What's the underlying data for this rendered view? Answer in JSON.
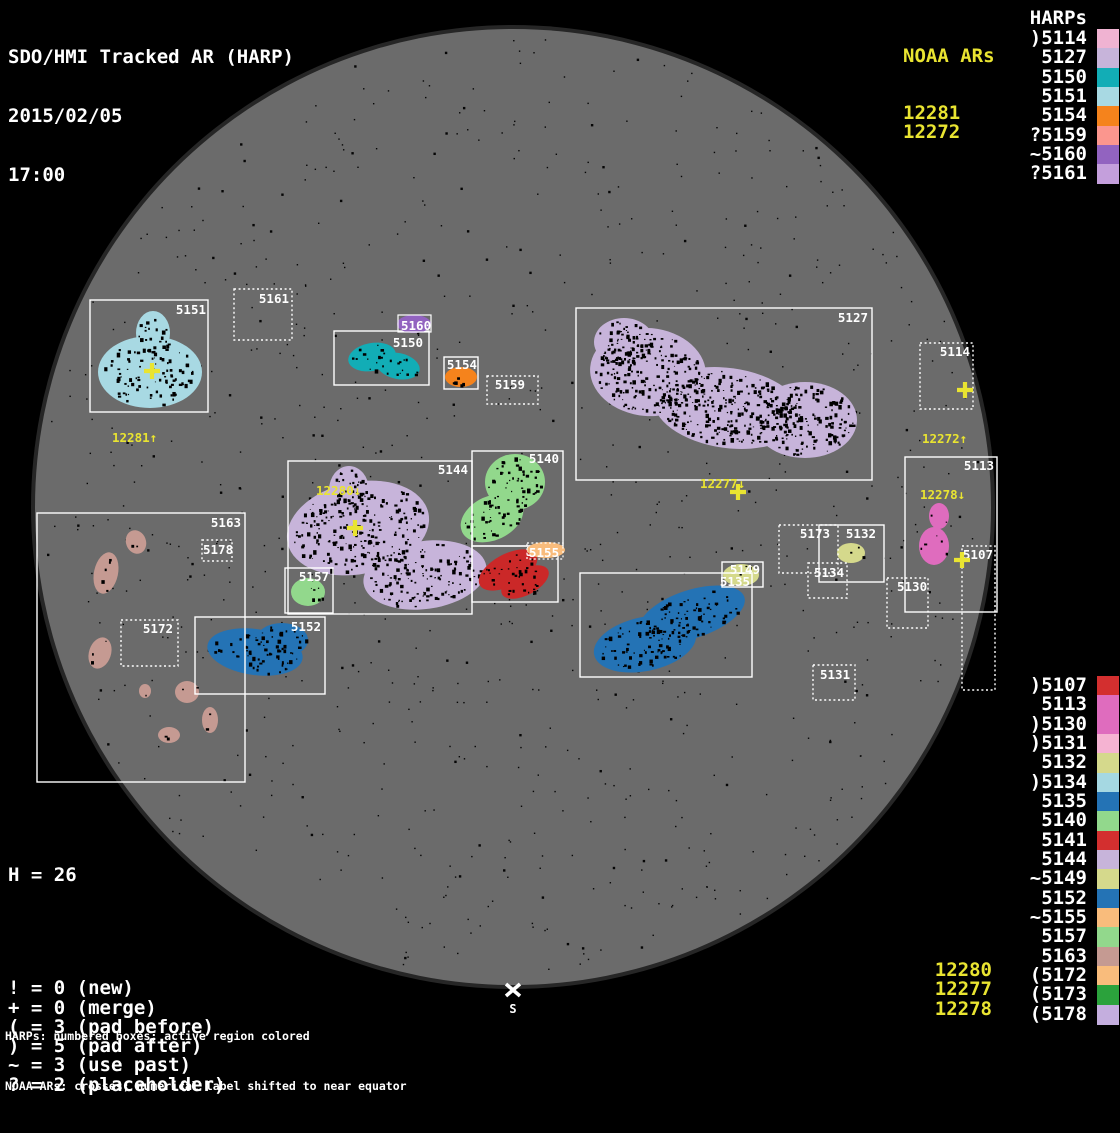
{
  "title": {
    "line1": "SDO/HMI Tracked AR (HARP)",
    "line2": "2015/02/05",
    "line3": "17:00"
  },
  "palette": {
    "yellow": "#e9e431",
    "white": "#ffffff",
    "disk_gray": "#6b6b6b",
    "disk_rim": "#262626",
    "background": "#000000",
    "speckle": "#050505"
  },
  "noaa_top": {
    "header": "NOAA ARs",
    "items": [
      "12281",
      "12272"
    ]
  },
  "harps_top": {
    "header": "HARPs",
    "items": [
      {
        "label": ")5114",
        "color": "#f0b3d2"
      },
      {
        "label": "5127",
        "color": "#c7b4da"
      },
      {
        "label": "5150",
        "color": "#12adb6"
      },
      {
        "label": "5151",
        "color": "#a8d9e3"
      },
      {
        "label": "5154",
        "color": "#f5831c"
      },
      {
        "label": "?5159",
        "color": "#fb968e"
      },
      {
        "label": "~5160",
        "color": "#9263c0"
      },
      {
        "label": "?5161",
        "color": "#c49fdc"
      }
    ]
  },
  "harps_bottom": {
    "items": [
      {
        "label": ")5107",
        "color": "#d32f2f"
      },
      {
        "label": "5113",
        "color": "#df6cbe"
      },
      {
        "label": ")5130",
        "color": "#df6cbe"
      },
      {
        "label": ")5131",
        "color": "#f5b3d2"
      },
      {
        "label": "5132",
        "color": "#d5d98c"
      },
      {
        "label": ")5134",
        "color": "#a5d8e2"
      },
      {
        "label": "5135",
        "color": "#2473b5"
      },
      {
        "label": "5140",
        "color": "#92d88c"
      },
      {
        "label": "5141",
        "color": "#d32f2f"
      },
      {
        "label": "5144",
        "color": "#c7b4da"
      },
      {
        "label": "~5149",
        "color": "#d5d98c"
      },
      {
        "label": "5152",
        "color": "#2473b5"
      },
      {
        "label": "~5155",
        "color": "#f9bc7c"
      },
      {
        "label": "5157",
        "color": "#92d88c"
      },
      {
        "label": "5163",
        "color": "#c59a92"
      },
      {
        "label": "(5172",
        "color": "#f9bc7c"
      },
      {
        "label": "(5173",
        "color": "#2ba23c"
      },
      {
        "label": "(5178",
        "color": "#c4aede"
      }
    ]
  },
  "noaa_bottom": [
    "12280",
    "12277",
    "12278"
  ],
  "stats": {
    "h": "H = 26",
    "legend": [
      "! = 0 (new)",
      "+ = 0 (merge)",
      "( = 3 (pad before)",
      ") = 5 (pad after)",
      "~ = 3 (use past)",
      "? = 2 (placeholder)"
    ]
  },
  "footer": [
    "HARPs: numbered boxes; active region colored",
    "NOAA ARs: crosses; numerical label shifted to near equator"
  ],
  "south_marker": {
    "text": "S",
    "x": 513,
    "y": 1013,
    "cross_x": 513,
    "cross_y": 990
  },
  "disk": {
    "cx": 513,
    "cy": 507,
    "r": 478
  },
  "regions": [
    {
      "harp": "5151",
      "box": [
        90,
        300,
        118,
        112
      ],
      "border": "solid",
      "label": {
        "text": "5151",
        "x": 206,
        "y": 314,
        "anchor": "end"
      },
      "color": "#a8d9e3",
      "blobs": [
        [
          150,
          372,
          52,
          36,
          0
        ],
        [
          153,
          333,
          17,
          22,
          0
        ]
      ],
      "speckle": 1.4
    },
    {
      "harp": "5161",
      "box": [
        234,
        289,
        58,
        51
      ],
      "border": "dashed",
      "label": {
        "text": "5161",
        "x": 289,
        "y": 303,
        "anchor": "end"
      }
    },
    {
      "harp": "5150",
      "box": [
        334,
        331,
        95,
        54
      ],
      "border": "solid",
      "label": {
        "text": "5150",
        "x": 423,
        "y": 347,
        "anchor": "end"
      },
      "color": "#12adb6",
      "blobs": [
        [
          372,
          357,
          24,
          14,
          -10
        ],
        [
          398,
          366,
          22,
          13,
          12
        ]
      ],
      "speckle": 1.2
    },
    {
      "harp": "5154",
      "box": [
        444,
        357,
        34,
        32
      ],
      "border": "solid",
      "label": {
        "text": "5154",
        "x": 477,
        "y": 369,
        "anchor": "end"
      },
      "color": "#f5831c",
      "blobs": [
        [
          461,
          377,
          16,
          10,
          0
        ]
      ],
      "speckle": 1.0
    },
    {
      "harp": "5159",
      "box": [
        487,
        376,
        51,
        28
      ],
      "border": "dashed",
      "label": {
        "text": "5159",
        "x": 525,
        "y": 389,
        "anchor": "end"
      }
    },
    {
      "harp": "5127",
      "box": [
        576,
        308,
        296,
        172
      ],
      "border": "solid",
      "label": {
        "text": "5127",
        "x": 868,
        "y": 322,
        "anchor": "end"
      },
      "color": "#c7b4da",
      "blobs": [
        [
          648,
          372,
          58,
          44,
          5
        ],
        [
          728,
          408,
          75,
          40,
          8
        ],
        [
          805,
          420,
          52,
          38,
          0
        ],
        [
          624,
          342,
          30,
          24,
          0
        ]
      ],
      "speckle": 2.2
    },
    {
      "harp": "5114",
      "box": [
        920,
        343,
        53,
        66
      ],
      "border": "dashed",
      "label": {
        "text": "5114",
        "x": 970,
        "y": 356,
        "anchor": "end"
      }
    },
    {
      "harp": "5113",
      "box": [
        905,
        457,
        92,
        155
      ],
      "border": "solid",
      "label": {
        "text": "5113",
        "x": 994,
        "y": 470,
        "anchor": "end"
      },
      "color": "#df6cbe",
      "blobs": [
        [
          939,
          516,
          10,
          13,
          0
        ],
        [
          934,
          546,
          15,
          19,
          0
        ]
      ],
      "speckle": 0.5
    },
    {
      "harp": "5107",
      "box": [
        962,
        546,
        33,
        144
      ],
      "border": "dashed",
      "label": {
        "text": "5107",
        "x": 993,
        "y": 559,
        "anchor": "end"
      }
    },
    {
      "harp": "5130",
      "box": [
        887,
        578,
        41,
        50
      ],
      "border": "dashed",
      "label": {
        "text": "5130",
        "x": 897,
        "y": 591,
        "anchor": "start"
      }
    },
    {
      "harp": "5173",
      "box": [
        779,
        525,
        59,
        48
      ],
      "border": "dashed",
      "label": {
        "text": "5173",
        "x": 830,
        "y": 538,
        "anchor": "end"
      }
    },
    {
      "harp": "5132",
      "box": [
        819,
        525,
        65,
        57
      ],
      "border": "solid",
      "label": {
        "text": "5132",
        "x": 876,
        "y": 538,
        "anchor": "end"
      },
      "color": "#d5d98c",
      "blobs": [
        [
          851,
          553,
          14,
          10,
          0
        ]
      ],
      "speckle": 0.6
    },
    {
      "harp": "5134",
      "box": [
        808,
        563,
        39,
        35
      ],
      "border": "dashed",
      "label": {
        "text": "5134",
        "x": 814,
        "y": 577,
        "anchor": "start"
      }
    },
    {
      "harp": "5131",
      "box": [
        813,
        665,
        42,
        35
      ],
      "border": "dashed",
      "label": {
        "text": "5131",
        "x": 820,
        "y": 679,
        "anchor": "start"
      }
    },
    {
      "harp": "5144",
      "box": [
        288,
        461,
        184,
        153
      ],
      "border": "solid",
      "label": {
        "text": "5144",
        "x": 468,
        "y": 474,
        "anchor": "end"
      },
      "color": "#c7b4da",
      "blobs": [
        [
          358,
          528,
          72,
          46,
          -12
        ],
        [
          425,
          575,
          62,
          34,
          -8
        ],
        [
          349,
          490,
          20,
          24,
          0
        ]
      ],
      "speckle": 1.8
    },
    {
      "harp": "5140",
      "box": [
        472,
        451,
        91,
        95
      ],
      "border": "solid",
      "label": {
        "text": "5140",
        "x": 559,
        "y": 463,
        "anchor": "end"
      },
      "color": "#92d88c",
      "blobs": [
        [
          515,
          482,
          30,
          28,
          0
        ],
        [
          492,
          518,
          33,
          22,
          -25
        ]
      ],
      "speckle": 1.5
    },
    {
      "harp": "5141",
      "box": [
        472,
        546,
        86,
        56
      ],
      "border": "solid",
      "color": "#cb2828",
      "blobs": [
        [
          508,
          570,
          32,
          16,
          -28
        ],
        [
          525,
          582,
          26,
          13,
          -28
        ]
      ],
      "speckle": 1.2
    },
    {
      "harp": "5157",
      "box": [
        285,
        568,
        48,
        45
      ],
      "border": "solid",
      "label": {
        "text": "5157",
        "x": 329,
        "y": 581,
        "anchor": "end"
      },
      "color": "#92d88c",
      "blobs": [
        [
          308,
          592,
          17,
          14,
          0
        ]
      ],
      "speckle": 0.8
    },
    {
      "harp": "5152",
      "box": [
        195,
        617,
        130,
        77
      ],
      "border": "solid",
      "label": {
        "text": "5152",
        "x": 321,
        "y": 631,
        "anchor": "end"
      },
      "color": "#2473b5",
      "blobs": [
        [
          255,
          652,
          48,
          23,
          8
        ],
        [
          282,
          640,
          26,
          17,
          0
        ]
      ],
      "speckle": 1.3
    },
    {
      "harp": "5135",
      "box": [
        580,
        573,
        172,
        104
      ],
      "border": "solid",
      "color": "#2473b5",
      "blobs": [
        [
          645,
          644,
          52,
          27,
          -12
        ],
        [
          692,
          614,
          55,
          24,
          -18
        ]
      ],
      "speckle": 1.5
    },
    {
      "harp": "5149",
      "box": [
        722,
        562,
        41,
        25
      ],
      "border": "solid",
      "label": {
        "text": "5149",
        "x": 760,
        "y": 574,
        "anchor": "end"
      },
      "color": "#d5d98c",
      "blobs": [
        [
          741,
          575,
          18,
          11,
          0
        ]
      ],
      "speckle": 0.5
    },
    {
      "harp": "5163",
      "box": [
        37,
        513,
        208,
        269
      ],
      "border": "solid",
      "label": {
        "text": "5163",
        "x": 241,
        "y": 527,
        "anchor": "end"
      },
      "color": "#c59a92",
      "blobs": [
        [
          136,
          542,
          10,
          12,
          -20
        ],
        [
          106,
          573,
          12,
          21,
          12
        ],
        [
          100,
          653,
          11,
          16,
          18
        ],
        [
          145,
          691,
          6,
          7,
          0
        ],
        [
          187,
          692,
          12,
          11,
          0
        ],
        [
          210,
          720,
          8,
          13,
          0
        ],
        [
          169,
          735,
          11,
          8,
          0
        ]
      ],
      "speckle": 0.5
    },
    {
      "harp": "5178",
      "box": [
        202,
        540,
        30,
        21
      ],
      "border": "dashed",
      "label": {
        "text": "5178",
        "x": 203,
        "y": 554,
        "anchor": "start"
      }
    },
    {
      "harp": "5172",
      "box": [
        121,
        620,
        57,
        46
      ],
      "border": "dashed",
      "label": {
        "text": "5172",
        "x": 173,
        "y": 633,
        "anchor": "end"
      }
    }
  ],
  "floating_labels": [
    {
      "text": "5135",
      "x": 750,
      "y": 586,
      "anchor": "end"
    },
    {
      "text": "5141",
      "x": 556,
      "y": 556,
      "anchor": "end"
    },
    {
      "text": "5155",
      "x": 529,
      "y": 557,
      "anchor": "start",
      "hl_color": "#f9bc7c",
      "hl_ellipse": [
        546,
        550,
        19,
        8
      ],
      "hl_border": "dashed",
      "hl_box": [
        527,
        543,
        36,
        16
      ]
    },
    {
      "text": "5160",
      "x": 401,
      "y": 330,
      "anchor": "start",
      "hl_color": "#9263c0",
      "hl_ellipse": [
        414,
        324,
        17,
        9
      ],
      "hl_border": "solid",
      "hl_box": [
        398,
        315,
        33,
        17
      ]
    }
  ],
  "crosses": [
    {
      "x": 152,
      "y": 371
    },
    {
      "x": 355,
      "y": 528
    },
    {
      "x": 738,
      "y": 492
    },
    {
      "x": 965,
      "y": 390
    },
    {
      "x": 962,
      "y": 560
    }
  ],
  "noaa_disk_labels": [
    {
      "text": "12281↑",
      "x": 112,
      "y": 442
    },
    {
      "text": "12280↓",
      "x": 316,
      "y": 495
    },
    {
      "text": "12277↓",
      "x": 700,
      "y": 488
    },
    {
      "text": "12272↑",
      "x": 922,
      "y": 443
    },
    {
      "text": "12278↓",
      "x": 920,
      "y": 499
    }
  ]
}
